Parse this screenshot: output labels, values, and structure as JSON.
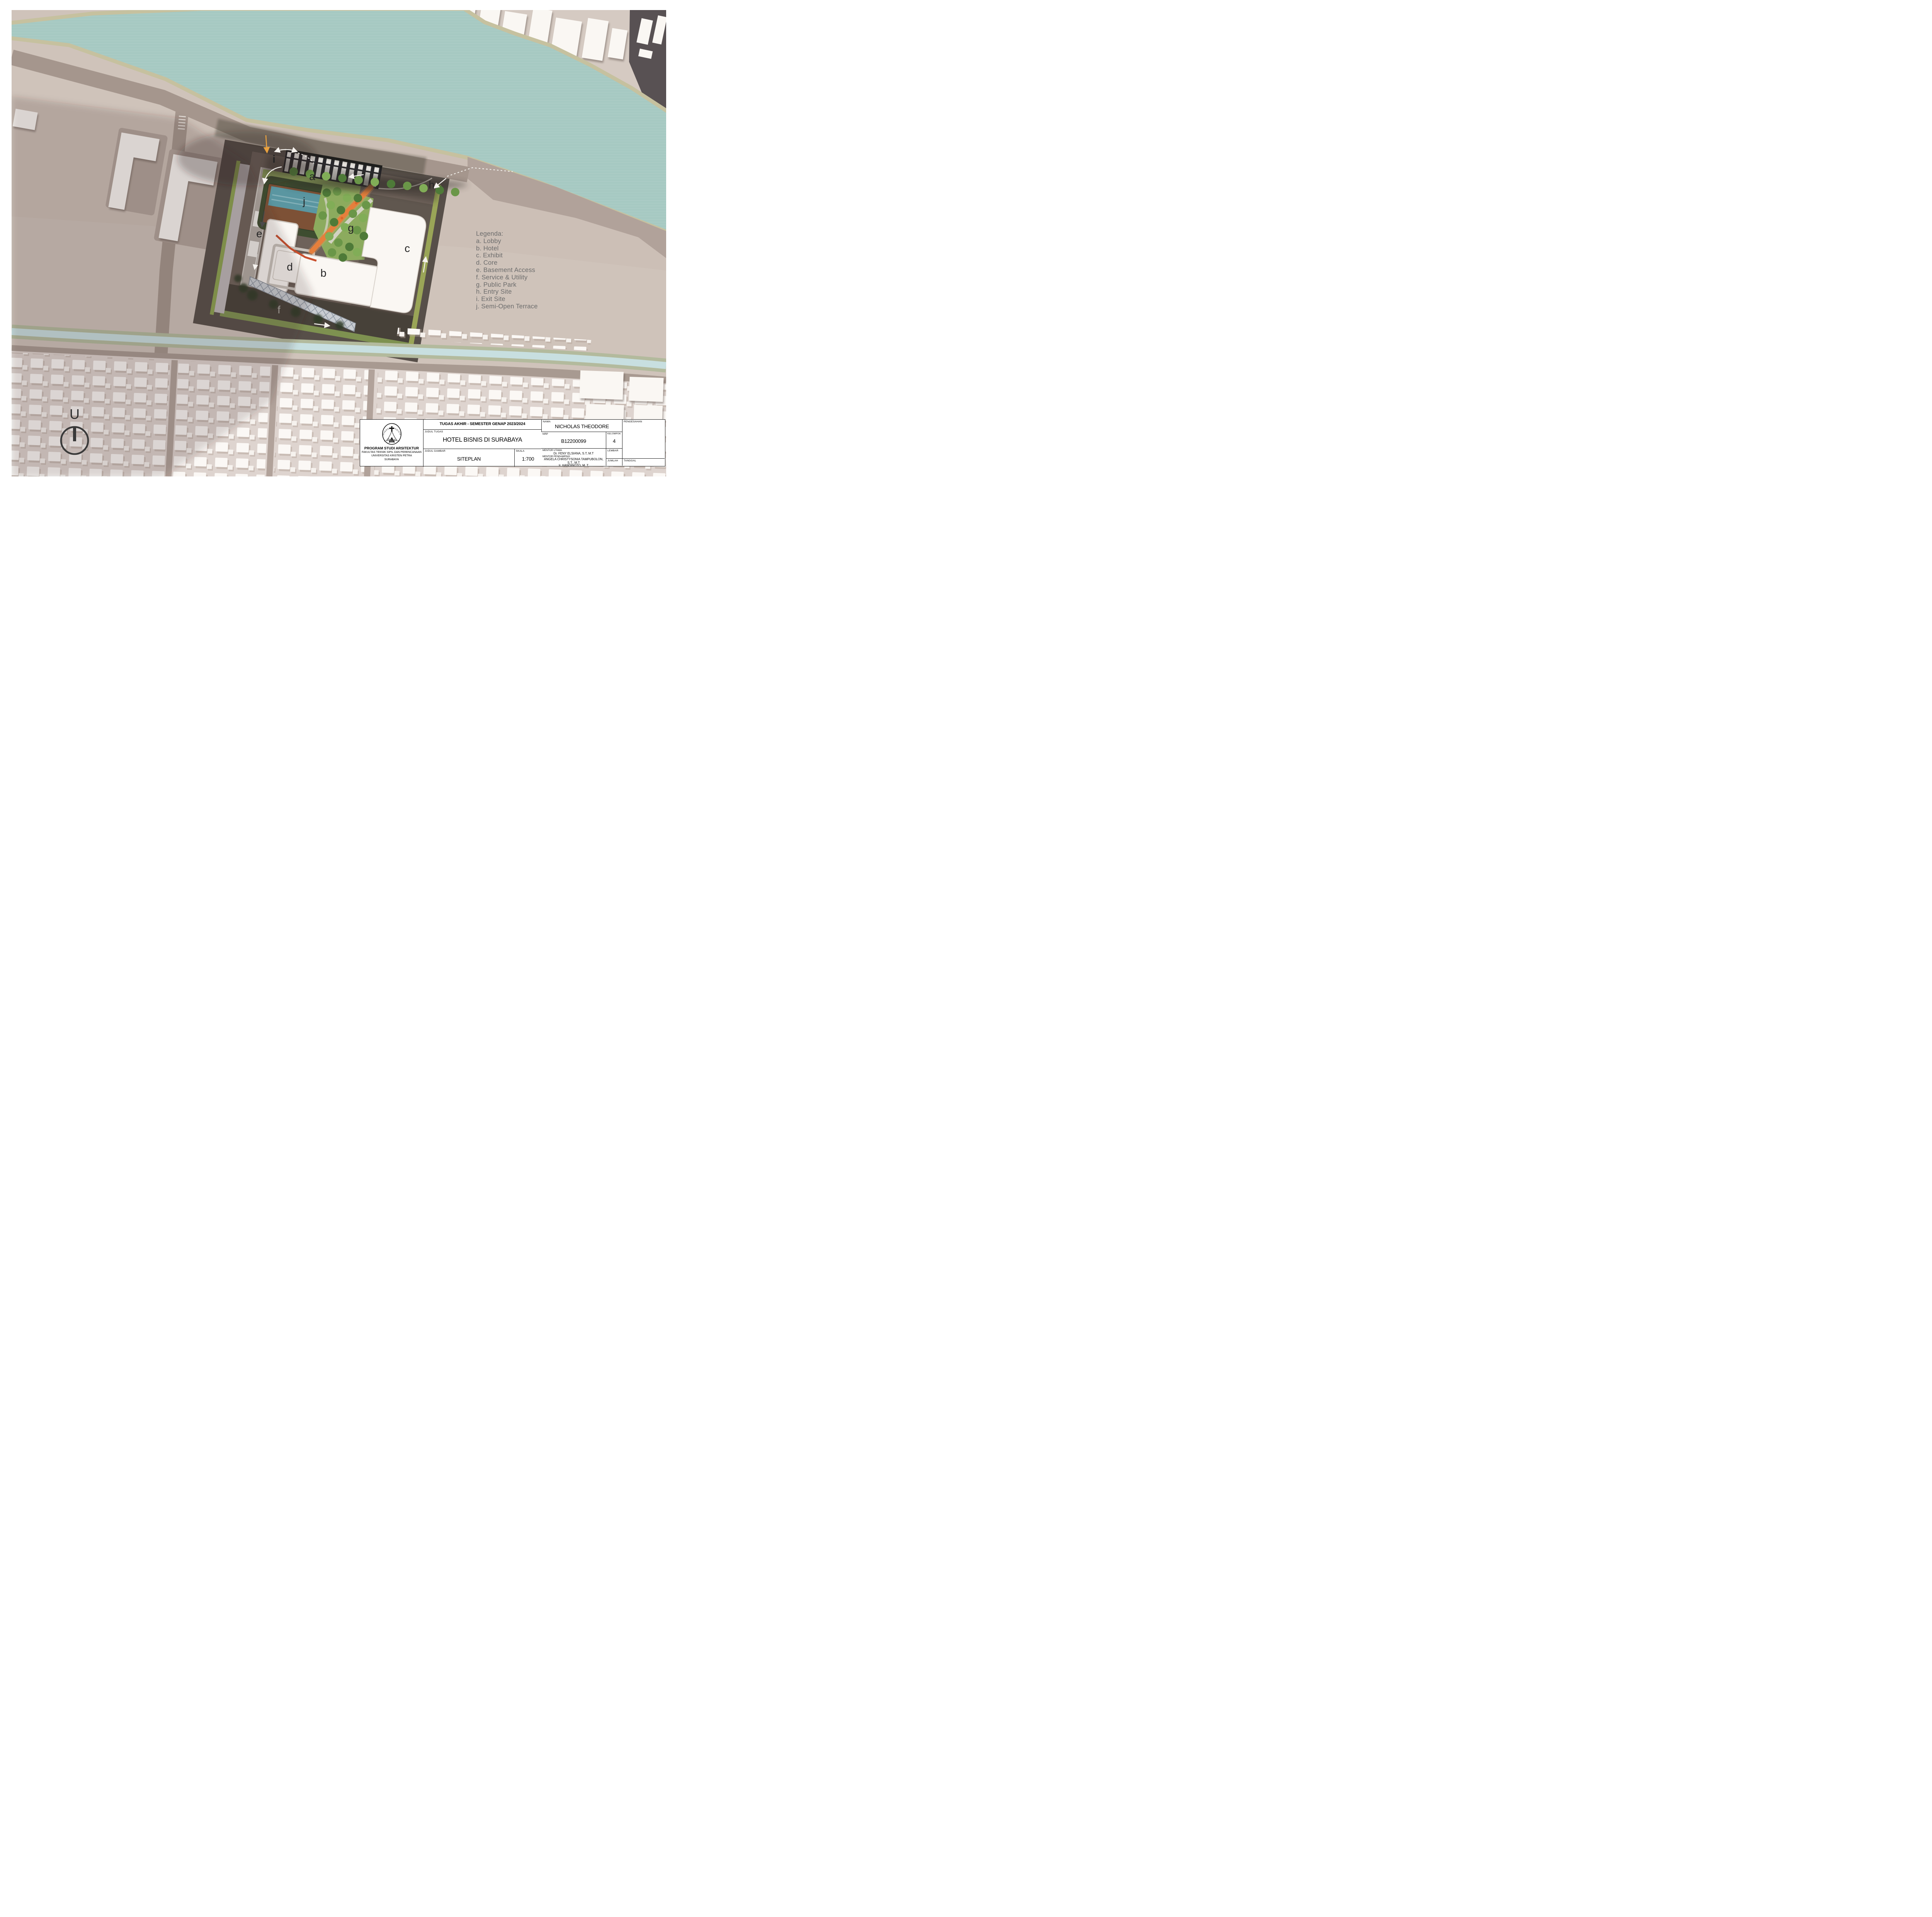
{
  "legend": {
    "title": "Legenda:",
    "items": [
      "a. Lobby",
      "b. Hotel",
      "c. Exhibit",
      "d. Core",
      "e. Basement Access",
      "f. Service & Utility",
      "g. Public Park",
      "h. Entry Site",
      "i. Exit Site",
      "j. Semi-Open Terrace"
    ]
  },
  "plan_labels": {
    "a": "a",
    "b": "b",
    "c": "c",
    "d": "d",
    "e": "e",
    "f": "f",
    "g": "g",
    "h": "h",
    "i": "i",
    "j": "j"
  },
  "north_label": "U",
  "logo": {
    "arc_top": "UNIVERSITAS KRISTEN",
    "arc_bottom": "PETRA"
  },
  "institution": {
    "line1": "PROGRAM STUDI ARSITEKTUR",
    "line2": "FAKULTAS TEKNIK SIPIL DAN PERENCANAAN",
    "line3": "UNIVERSITAS KRISTEN PETRA",
    "line4": "SURABAYA"
  },
  "titleblock": {
    "header": "TUGAS AKHIR - SEMESTER GENAP 2023/2024",
    "judul_tugas_label": "JUDUL TUGAS",
    "judul_tugas": "HOTEL BISNIS DI SURABAYA",
    "judul_gambar_label": "JUDUL GAMBAR",
    "judul_gambar": "SITEPLAN",
    "skala_label": "SKALA",
    "skala": "1:700",
    "nama_label": "NAMA",
    "nama": "NICHOLAS THEODORE",
    "nrp_label": "NRP",
    "nrp": "B12200099",
    "kelompok_label": "KELOMPOK",
    "kelompok": "4",
    "mentor_utama_label": "MENTOR UTAMA",
    "mentor_utama": "Dr. FENY ELSIANA, S.T, M.T",
    "mentor_pendamping_label": "MENTOR PENDAMPING",
    "mentor_pendamping_1": "ANGELA CHRISTYSONIA TAMPUBOLON, S.T., M.T",
    "mentor_pendamping_2": "Ir. HANDINOTO, M. T",
    "pengesahan_label": "PENGESAHAN",
    "lembar_label": "LEMBAR",
    "jumlah_label": "JUMLAH",
    "tanggal_label": "TANGGAL"
  },
  "colors": {
    "river_water": "#a6c9c2",
    "river_bank": "#c6c19f",
    "road": "#a5968d",
    "ground": "#cfc3ba",
    "site_ground": "#6e625a",
    "service_road": "#474139",
    "park_green": "#8cab5e",
    "border_green": "#9aa557",
    "pool": "#5a96a1",
    "pool_deck": "#7d5136",
    "orange_path": "#e57f3c",
    "building_white": "#faf7f3",
    "canal": "#c8dfe0",
    "legend_text": "#6c6c6c"
  }
}
